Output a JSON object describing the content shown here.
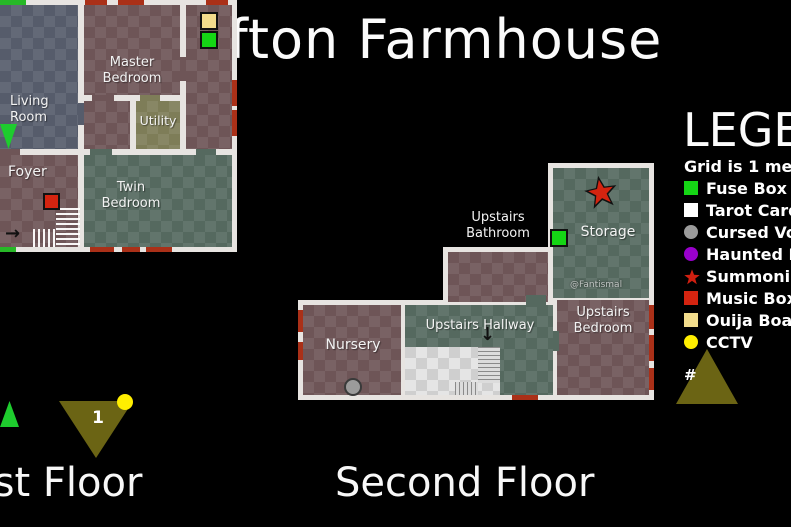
{
  "title": "Grafton Farmhouse",
  "floors": {
    "first": {
      "label": "First Floor",
      "rooms": {
        "living": "Living Room",
        "master": "Master Bedroom",
        "utility": "Utility",
        "foyer": "Foyer",
        "twin": "Twin Bedroom"
      },
      "stair_marker": "1"
    },
    "second": {
      "label": "Second Floor",
      "rooms": {
        "nursery": "Nursery",
        "hallway": "Upstairs Hallway",
        "bathroom": "Upstairs Bathroom",
        "bedroom": "Upstairs Bedroom",
        "storage": "Storage"
      },
      "watermark": "@Fantismal",
      "stair_marker": "#"
    }
  },
  "legend": {
    "title": "LEGEND",
    "note": "Grid is 1 meter",
    "items": [
      {
        "name": "fuse-box",
        "shape": "square",
        "color": "#15d615",
        "label": "Fuse Box"
      },
      {
        "name": "tarot-cards",
        "shape": "square",
        "color": "#ffffff",
        "label": "Tarot Cards"
      },
      {
        "name": "cursed-voodoo",
        "shape": "circle",
        "color": "#9b9b9b",
        "label": "Cursed Voodoo"
      },
      {
        "name": "haunted-mirror",
        "shape": "circle",
        "color": "#9900cc",
        "label": "Haunted Mirror"
      },
      {
        "name": "summoning-circle",
        "shape": "star",
        "color": "#cf1f10",
        "label": "Summoning Circle"
      },
      {
        "name": "music-box",
        "shape": "square",
        "color": "#d42410",
        "label": "Music Box"
      },
      {
        "name": "ouija-board",
        "shape": "square",
        "color": "#f2dc8c",
        "label": "Ouija Board"
      },
      {
        "name": "cctv",
        "shape": "circle",
        "color": "#ffee00",
        "label": "CCTV"
      }
    ]
  },
  "markers": {
    "first_floor": [
      "ouija-board",
      "fuse-box",
      "music-box",
      "cctv"
    ],
    "second_floor": [
      "summoning-circle",
      "fuse-box",
      "cursed-voodoo"
    ]
  },
  "palette": {
    "green": "#15d615",
    "red": "#d42410",
    "yellow": "#ffee00",
    "tan": "#f2dc8c",
    "gray": "#9b9b9b",
    "purple": "#9900cc",
    "white": "#ffffff",
    "wall": "#e7e4e1",
    "window_dash": "#aa3018",
    "door_dash": "#27b827",
    "stair_triangle": "#6b6414",
    "entry_triangle": "#1ecc2e",
    "room_mauve": "#6e5557",
    "room_bluegray": "#565c6b",
    "room_teal": "#55695f",
    "room_khaki": "#7e7d58"
  }
}
